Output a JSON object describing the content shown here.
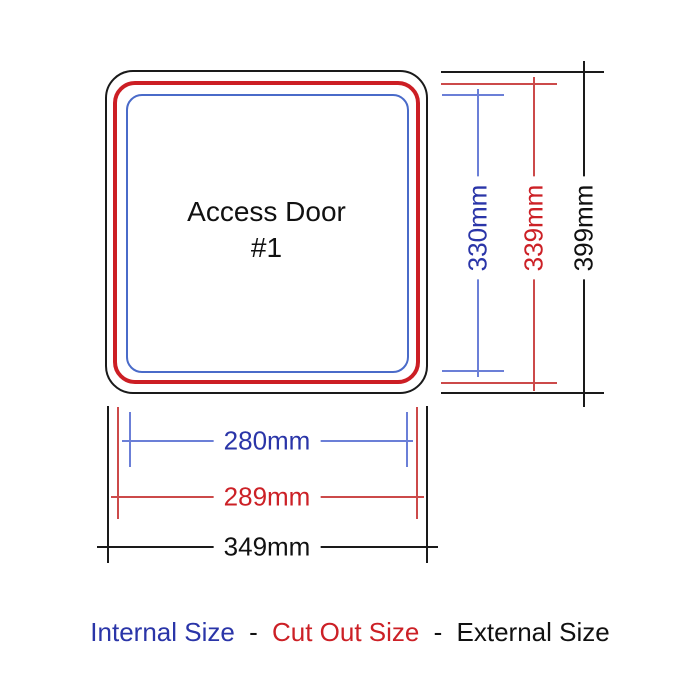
{
  "door": {
    "title_line1": "Access Door",
    "title_line2": "#1"
  },
  "dimensions": {
    "height": {
      "internal": "330mm",
      "cut_out": "339mm",
      "external": "399mm"
    },
    "width": {
      "internal": "280mm",
      "cut_out": "289mm",
      "external": "349mm"
    }
  },
  "legend": {
    "internal_label": "Internal Size",
    "separator1": "-",
    "cut_out_label": "Cut Out Size",
    "separator2": "-",
    "external_label": "External Size"
  },
  "colors": {
    "internal_text": "#2a35a8",
    "internal_line": "#6b7fd7",
    "internal_border": "#4a6bc9",
    "cut_out_text": "#cc2026",
    "cut_out_line": "#cc4a4a",
    "cut_out_border": "#cc1e24",
    "external_text": "#111111",
    "external_line": "#1a1a1a"
  }
}
